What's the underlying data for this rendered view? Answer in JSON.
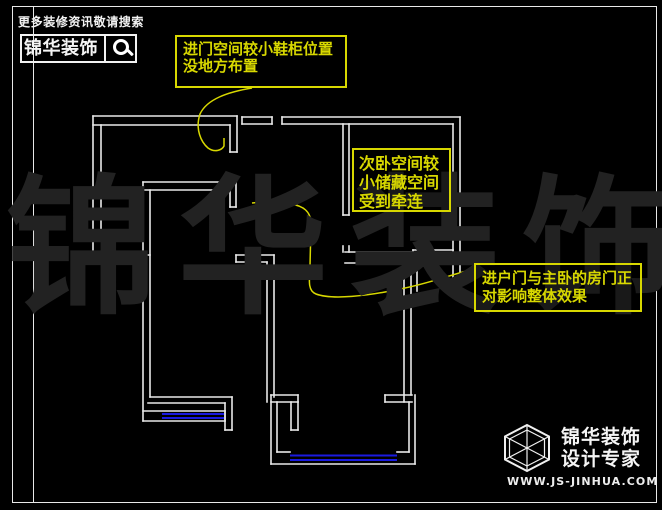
{
  "colors": {
    "background": "#000000",
    "wall": "#e9e9e9",
    "window": "#1a1ae0",
    "annotation_yellow": "#d8d800",
    "watermark_gray": "#222222",
    "frame_white": "#e8e8e8"
  },
  "header": {
    "tagline": "更多装修资讯敬请搜索",
    "brand": "锦华装饰",
    "search_icon": "magnifier"
  },
  "watermark": {
    "text": "锦华装饰"
  },
  "annotations": {
    "box1": {
      "lines": [
        "进门空间较小鞋柜位置",
        "没地方布置"
      ]
    },
    "box2": {
      "lines": [
        "次卧空间较",
        "小储藏空间",
        "受到牵连"
      ]
    },
    "box3": {
      "lines": [
        "进户门与主卧的房门正",
        "对影响整体效果"
      ]
    }
  },
  "footer": {
    "brand_line1": "锦华装饰",
    "brand_line2": "设计专家",
    "website": "WWW.JS-JINHUA.COM",
    "logo_icon": "wireframe-cube"
  },
  "floor_plan": {
    "walls": [
      [
        93,
        116,
        237,
        116
      ],
      [
        93,
        125,
        230,
        125
      ],
      [
        93,
        116,
        93,
        262
      ],
      [
        101,
        125,
        101,
        231
      ],
      [
        230,
        125,
        230,
        152
      ],
      [
        237,
        116,
        237,
        152
      ],
      [
        230,
        152,
        237,
        152
      ],
      [
        242,
        117,
        272,
        117
      ],
      [
        242,
        124,
        272,
        124
      ],
      [
        242,
        117,
        242,
        124
      ],
      [
        272,
        117,
        272,
        124
      ],
      [
        282,
        117,
        282,
        124
      ],
      [
        282,
        117,
        460,
        117
      ],
      [
        282,
        124,
        453,
        124
      ],
      [
        453,
        124,
        453,
        290
      ],
      [
        460,
        117,
        460,
        290
      ],
      [
        453,
        290,
        460,
        290
      ],
      [
        343,
        124,
        343,
        215
      ],
      [
        349,
        124,
        349,
        215
      ],
      [
        343,
        215,
        349,
        215
      ],
      [
        343,
        246,
        343,
        252
      ],
      [
        349,
        246,
        349,
        252
      ],
      [
        345,
        252,
        413,
        252
      ],
      [
        345,
        263,
        413,
        263
      ],
      [
        413,
        250,
        453,
        250
      ],
      [
        413,
        264,
        453,
        264
      ],
      [
        413,
        250,
        413,
        264
      ],
      [
        453,
        250,
        453,
        264
      ],
      [
        417,
        264,
        417,
        291
      ],
      [
        404,
        263,
        404,
        402
      ],
      [
        411,
        264,
        411,
        395
      ],
      [
        143,
        182,
        236,
        182
      ],
      [
        143,
        190,
        230,
        190
      ],
      [
        230,
        190,
        230,
        207
      ],
      [
        236,
        182,
        236,
        207
      ],
      [
        230,
        207,
        236,
        207
      ],
      [
        143,
        182,
        143,
        421
      ],
      [
        150,
        190,
        150,
        397
      ],
      [
        93,
        255,
        150,
        255
      ],
      [
        93,
        262,
        143,
        262
      ],
      [
        98,
        231,
        142,
        231
      ],
      [
        98,
        231,
        98,
        240
      ],
      [
        142,
        231,
        142,
        240
      ],
      [
        236,
        255,
        274,
        255
      ],
      [
        236,
        262,
        267,
        262
      ],
      [
        236,
        255,
        236,
        262
      ],
      [
        267,
        262,
        267,
        402
      ],
      [
        274,
        255,
        274,
        397
      ],
      [
        150,
        397,
        232,
        397
      ],
      [
        148,
        403,
        225,
        403
      ],
      [
        225,
        403,
        225,
        430
      ],
      [
        232,
        397,
        232,
        430
      ],
      [
        225,
        430,
        232,
        430
      ],
      [
        143,
        411,
        225,
        411
      ],
      [
        143,
        421,
        225,
        421
      ],
      [
        225,
        411,
        225,
        421
      ],
      [
        271,
        395,
        298,
        395
      ],
      [
        271,
        402,
        298,
        402
      ],
      [
        298,
        395,
        298,
        402
      ],
      [
        291,
        402,
        291,
        430
      ],
      [
        298,
        402,
        298,
        430
      ],
      [
        291,
        430,
        298,
        430
      ],
      [
        385,
        395,
        412,
        395
      ],
      [
        385,
        402,
        412,
        402
      ],
      [
        385,
        395,
        385,
        402
      ],
      [
        271,
        395,
        271,
        464
      ],
      [
        277,
        402,
        277,
        452
      ],
      [
        409,
        402,
        409,
        452
      ],
      [
        415,
        395,
        415,
        464
      ],
      [
        271,
        464,
        415,
        464
      ],
      [
        277,
        452,
        290,
        452
      ],
      [
        397,
        452,
        409,
        452
      ]
    ],
    "windows": [
      [
        98,
        234,
        142,
        234
      ],
      [
        98,
        238.5,
        142,
        238.5
      ],
      [
        162,
        414,
        224,
        414
      ],
      [
        162,
        418,
        224,
        418
      ],
      [
        290,
        455.5,
        397,
        455.5
      ],
      [
        290,
        460,
        397,
        460
      ],
      [
        413,
        254,
        453,
        254
      ],
      [
        413,
        260.5,
        453,
        260.5
      ]
    ],
    "leaders": [
      "M252,88 C228,92 207,99 200,114 C195,129 201,142 208,148 C215,153 222,150 224,146 L224,138",
      "M474,269 C456,273 428,284 400,289 C368,296 332,300 316,294 C308,291 309,282 310,266 L311,224 C311,211 303,206 291,204 C277,202 260,202 252,203"
    ]
  }
}
